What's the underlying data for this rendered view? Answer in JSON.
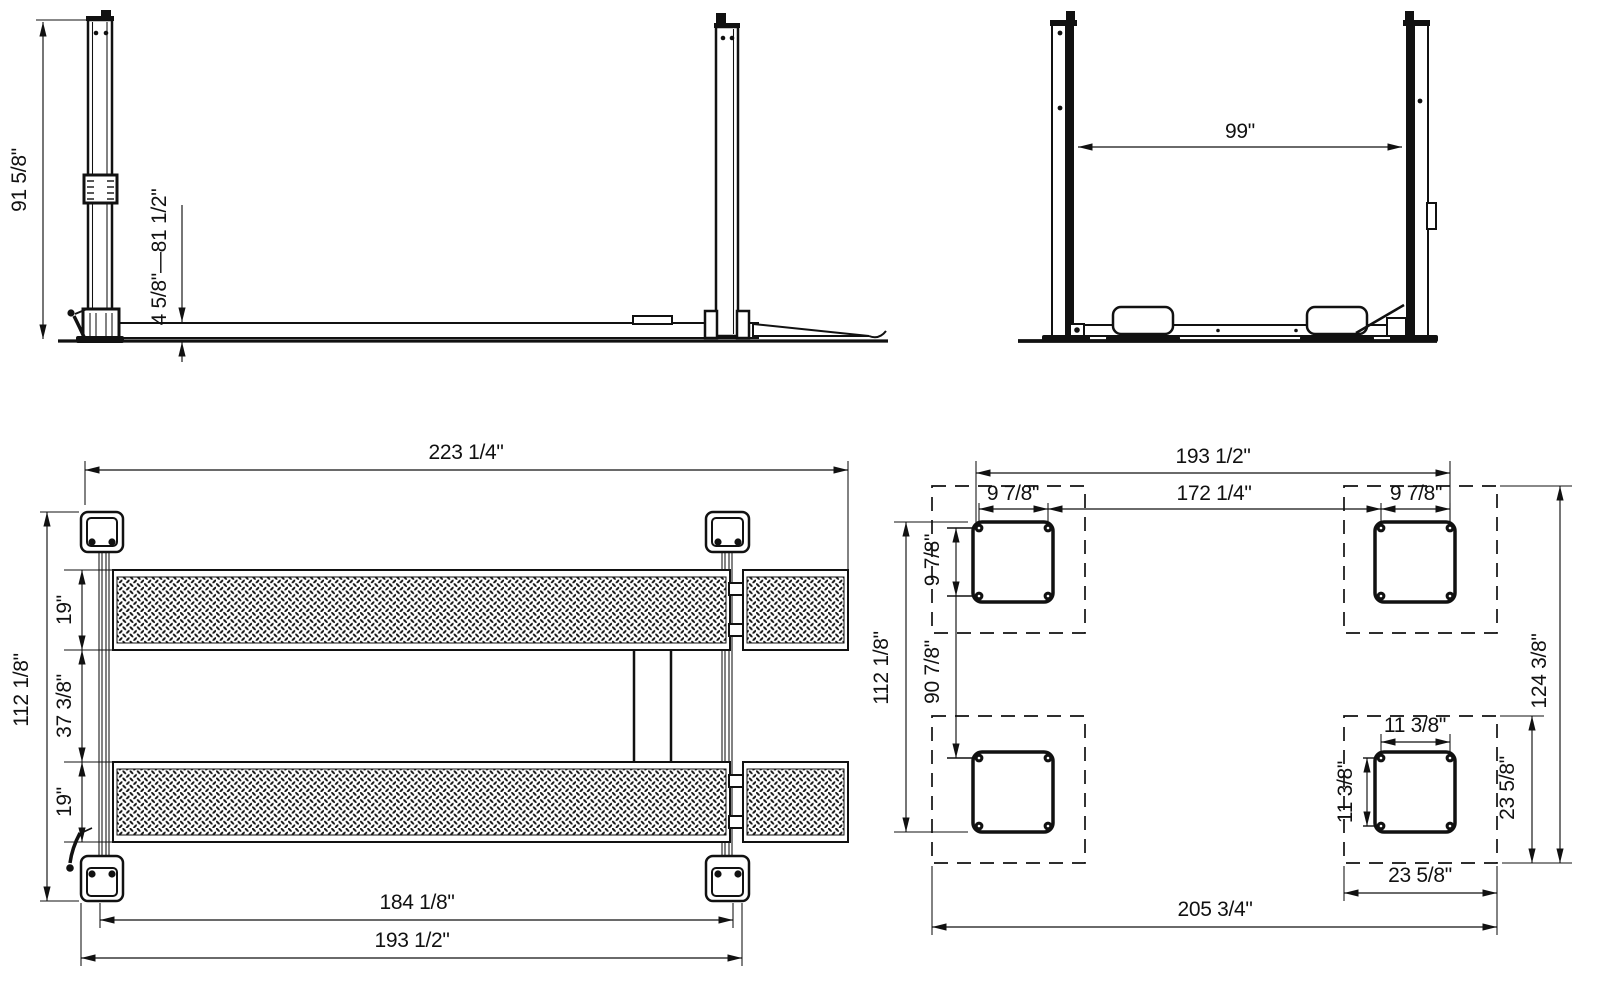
{
  "drawing": {
    "side_view": {
      "overall_height": "91 5/8\"",
      "lift_range": "4 5/8\"—81 1/2\""
    },
    "front_view": {
      "between_posts": "99\""
    },
    "plan_view": {
      "overall_length": "223 1/4\"",
      "runway_width": "19\"",
      "between_runways": "37 3/8\"",
      "overall_width": "112 1/8\"",
      "runway_span": "184 1/8\"",
      "post_span": "193 1/2\""
    },
    "base_view": {
      "post_span": "193 1/2\"",
      "inner_bolt_span": "172 1/4\"",
      "bolt_width": "9 7/8\"",
      "bolt_height": "9 7/8\"",
      "bolt_row_span": "90 7/8\"",
      "overall_width": "112 1/8\"",
      "overall_height": "124 3/8\"",
      "bolt_width_2": "11 3/8\"",
      "bolt_height_2": "11 3/8\"",
      "pad_width": "23 5/8\"",
      "pad_height": "23 5/8\"",
      "outer_span": "205 3/4\""
    }
  }
}
